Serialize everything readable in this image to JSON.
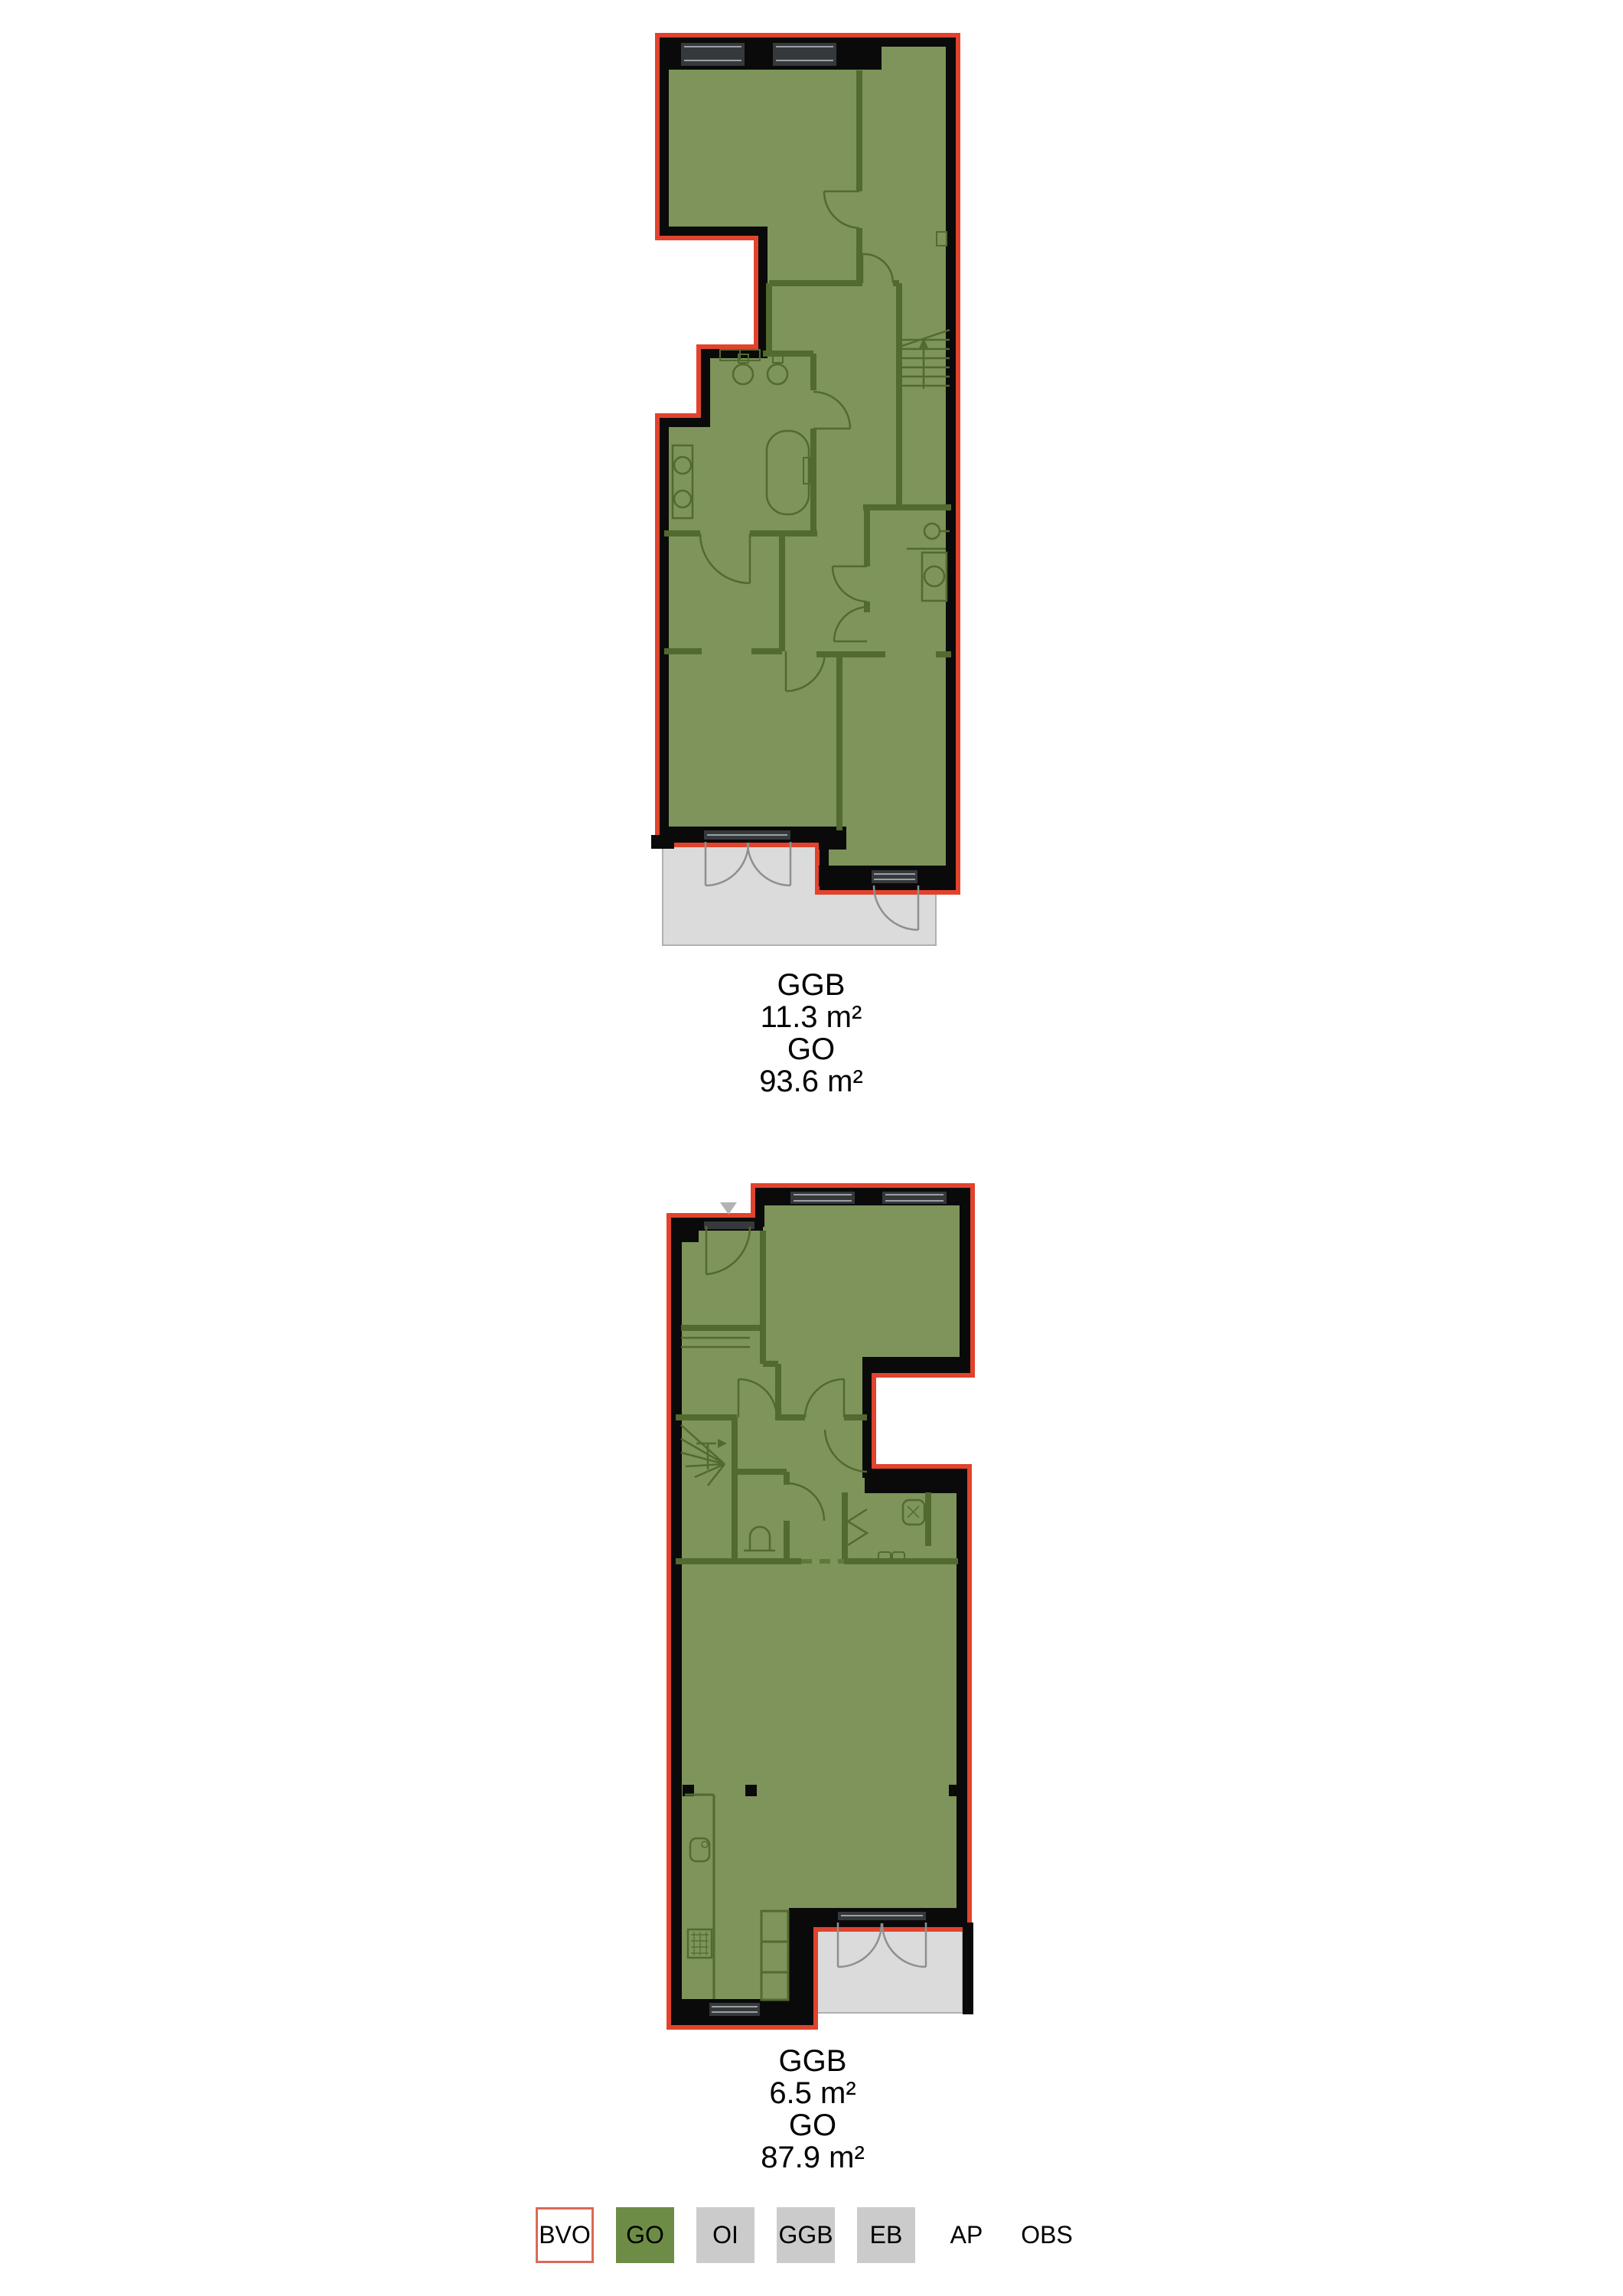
{
  "document": {
    "background": "#ffffff",
    "type": "floor-plan-measurement-drawing"
  },
  "plans": [
    {
      "name": "upper-floor-plan",
      "area_labels": {
        "ggb_label": "GGB",
        "ggb_value": "11.3 m²",
        "go_label": "GO",
        "go_value": "93.6 m²"
      }
    },
    {
      "name": "lower-floor-plan",
      "area_labels": {
        "ggb_label": "GGB",
        "ggb_value": "6.5 m²",
        "go_label": "GO",
        "go_value": "87.9 m²"
      }
    }
  ],
  "legend": {
    "items": [
      {
        "label": "BVO",
        "swatch_fill": "#ffffff",
        "swatch_border": "#d96a55"
      },
      {
        "label": "GO",
        "swatch_fill": "#6d8c46"
      },
      {
        "label": "OI",
        "swatch_fill": "#cbcbcb"
      },
      {
        "label": "GGB",
        "swatch_fill": "#cbcbcb"
      },
      {
        "label": "EB",
        "swatch_fill": "#cbcbcb"
      },
      {
        "label": "AP",
        "swatch_fill": "none"
      },
      {
        "label": "OBS",
        "swatch_fill": "none"
      }
    ]
  },
  "colors": {
    "bvo_outline_red": "#e1432c",
    "go_area_green": "#7e945a",
    "ggb_area_gray": "#dbdbdb",
    "wall_black": "#0a0a0a",
    "interior_wall_green": "#52692f",
    "window_glass_gray": "#36393c",
    "balcony_door_line_gray": "#8f8f8f",
    "marker_triangle_gray": "#b3b3b3"
  }
}
